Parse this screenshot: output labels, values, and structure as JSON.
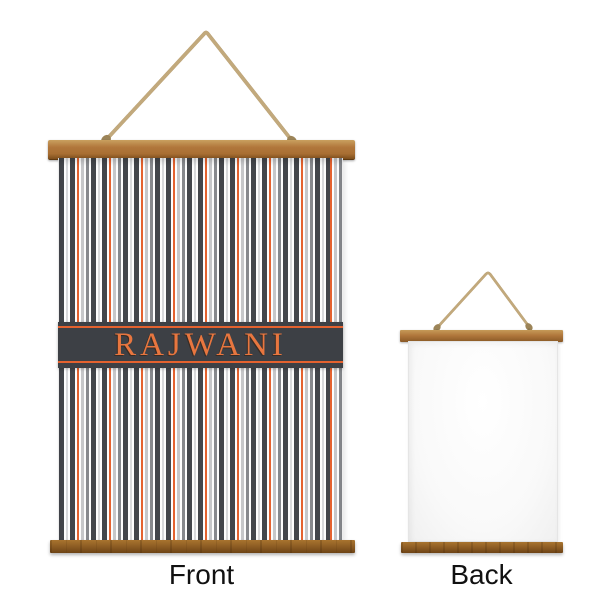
{
  "product": {
    "personalization_text": "RAJWANI",
    "pattern_name": "gray-orange-vertical-stripes",
    "views": [
      {
        "id": "front",
        "label": "Front"
      },
      {
        "id": "back",
        "label": "Back"
      }
    ]
  },
  "colors": {
    "page_bg": "#ffffff",
    "accent_orange": "#e4622f",
    "text_orange": "#e8763f",
    "band_charcoal": "#3d4045",
    "stripe_charcoal": "#43464b",
    "stripe_gray": "#87898d",
    "stripe_light": "#c6c7c9",
    "stripe_silver": "#d8d9db",
    "stripe_white": "#fdfdfd",
    "stripe_orange": "#e4622f",
    "wood_light": "#c9a05f",
    "wood_mid": "#b1773c",
    "wood_dark": "#7d4e1c",
    "wood_bottom": "#8a5a22",
    "rope_tan": "#b59c6f",
    "rope_dark": "#9c8458",
    "label_black": "#111111"
  }
}
